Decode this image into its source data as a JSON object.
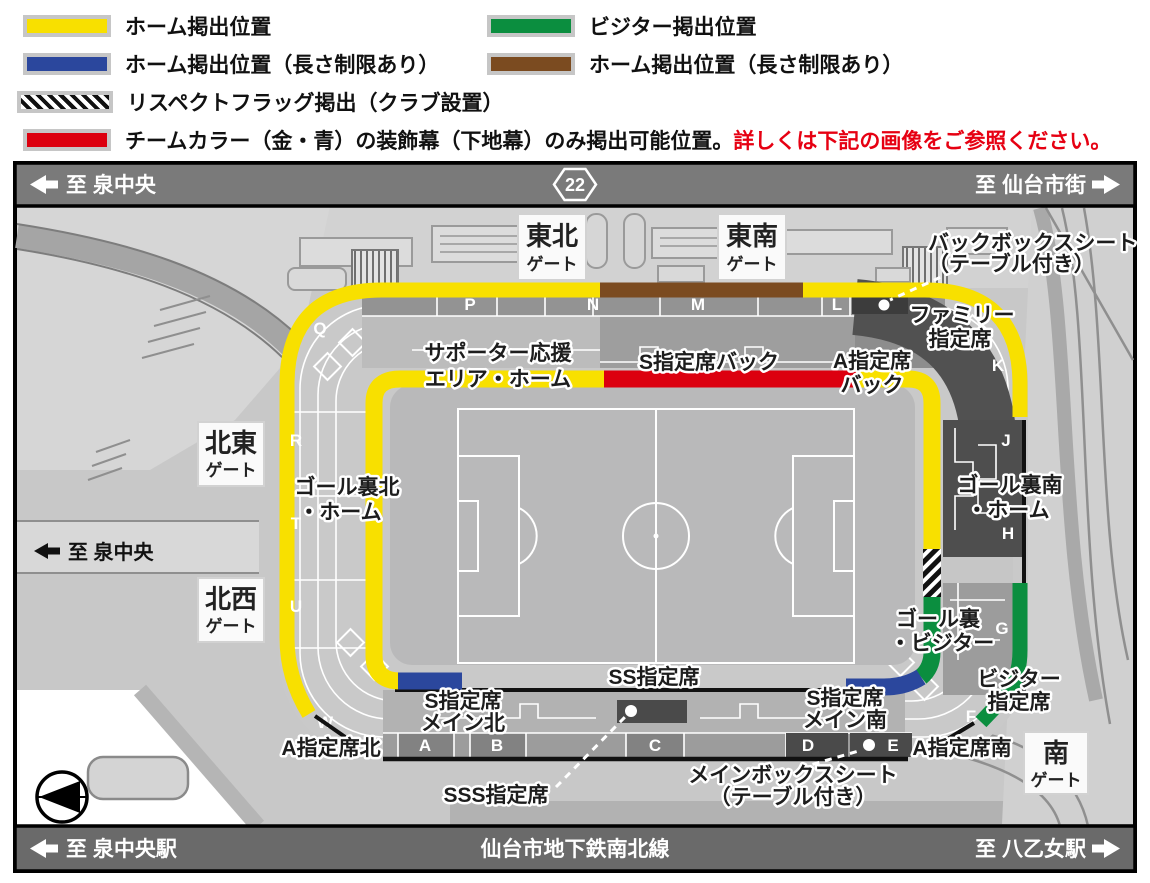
{
  "legend": {
    "home": "ホーム掲出位置",
    "home_limited_blue": "ホーム掲出位置（長さ制限あり）",
    "respect_flag": "リスペクトフラッグ掲出（クラブ設置）",
    "team_color": "チームカラー（金・青）の装飾幕（下地幕）のみ掲出可能位置。",
    "team_color_note": "詳しくは下記の画像をご参照ください。",
    "visitor": "ビジター掲出位置",
    "home_limited_brown": "ホーム掲出位置（長さ制限あり）"
  },
  "roads": {
    "top_left": "至 泉中央",
    "route_number": "22",
    "top_right": "至 仙台市街",
    "map_left": "至 泉中央",
    "bottom_left": "至 泉中央駅",
    "bottom_center": "仙台市地下鉄南北線",
    "bottom_right": "至 八乙女駅"
  },
  "gates": {
    "suffix": "ゲート",
    "tohoku": "東北",
    "tonan": "東南",
    "hokuto": "北東",
    "hokusei": "北西",
    "minami": "南"
  },
  "areas": {
    "supporter1": "サポーター応援",
    "supporter2": "エリア・ホーム",
    "s_back": "S指定席バック",
    "a_back1": "A指定席",
    "a_back2": "バック",
    "family1": "ファミリー",
    "family2": "指定席",
    "backbox1": "バックボックスシート",
    "backbox2": "（テーブル付き）",
    "goal_n1": "ゴール裏北",
    "goal_n2": "・ホーム",
    "goal_s1": "ゴール裏南",
    "goal_s2": "・ホーム",
    "goal_v1": "ゴール裏",
    "goal_v2": "・ビジター",
    "visitor1": "ビジター",
    "visitor2": "指定席",
    "ss": "SS指定席",
    "s_main_n1": "S指定席",
    "s_main_n2": "メイン北",
    "s_main_s1": "S指定席",
    "s_main_s2": "メイン南",
    "sss": "SSS指定席",
    "mainbox1": "メインボックスシート",
    "mainbox2": "（テーブル付き）",
    "a_north": "A指定席北",
    "a_south": "A指定席南"
  },
  "letters": {
    "q": "Q",
    "p": "P",
    "n": "N",
    "m": "M",
    "l": "L",
    "k": "K",
    "j": "J",
    "h": "H",
    "g": "G",
    "f": "F",
    "w": "W",
    "u": "U",
    "t": "T",
    "r": "R",
    "a": "A",
    "b": "B",
    "c": "C",
    "d": "D",
    "e": "E"
  },
  "colors": {
    "home_yellow": "#f8e000",
    "home_blue": "#2b479d",
    "visitor_green": "#0b8e3f",
    "home_brown": "#7b4b20",
    "team_red": "#dc000f",
    "road_gray": "#7a7a7a"
  }
}
